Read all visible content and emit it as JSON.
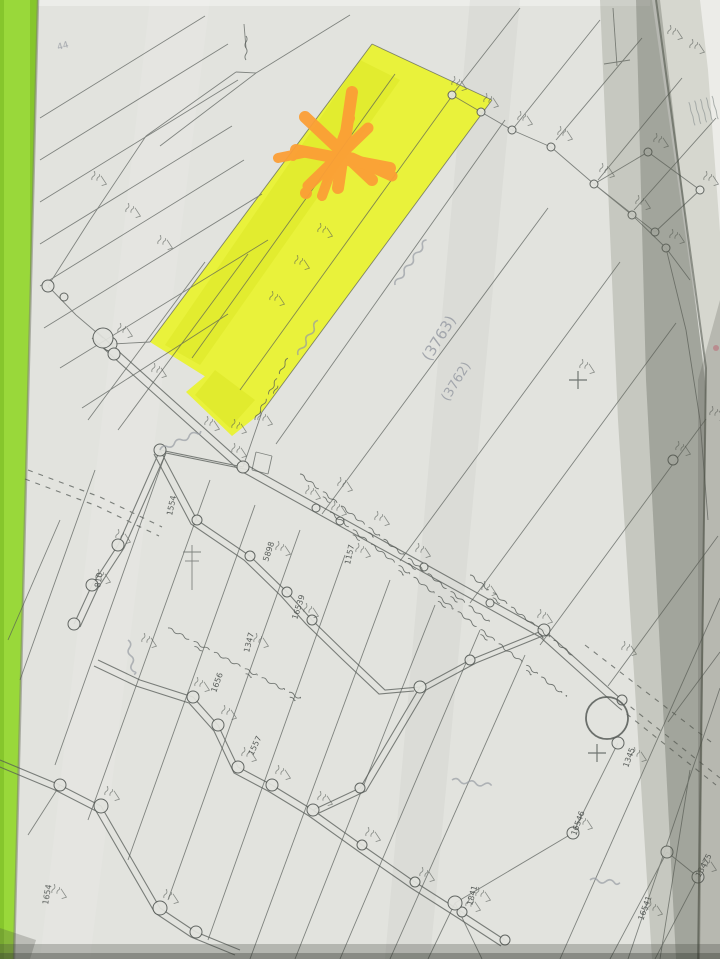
{
  "meta": {
    "description": "Photograph of a hand-drawn cadastral parcel survey map on grey paper lying on a green surface; one long parcel is highlighted in yellow with an orange marker asterisk; roads, survey-marker circles and handwritten parcel numbers cover the sheet"
  },
  "colors": {
    "green_bg": "#86c62c",
    "green_light": "#9bd93c",
    "paper": "#e2e3de",
    "under_sheet": "#d6d7cf",
    "white_corner": "#ecece8",
    "ink": "#565b57",
    "pencil": "#989ca4",
    "highlight": "#e9f23b",
    "highlight_dark": "#d9e422",
    "orange": "#fb9f36",
    "pink_dot": "#d98f98"
  },
  "canvas": {
    "width": 720,
    "height": 959
  },
  "sheets": {
    "under": [
      [
        640,
        0
      ],
      [
        720,
        0
      ],
      [
        720,
        959
      ],
      [
        660,
        959
      ]
    ],
    "white_corner": [
      [
        700,
        0
      ],
      [
        720,
        0
      ],
      [
        720,
        232
      ],
      [
        708,
        70
      ]
    ],
    "map": [
      [
        38,
        0
      ],
      [
        656,
        0
      ],
      [
        706,
        360
      ],
      [
        698,
        959
      ],
      [
        14,
        959
      ]
    ],
    "fineprint": {
      "x": 712,
      "y": 96,
      "rot": 75,
      "rows": 5,
      "len": 24,
      "gap": 6
    }
  },
  "highlight_parcel": {
    "main": [
      [
        372,
        44
      ],
      [
        492,
        100
      ],
      [
        262,
        412
      ],
      [
        150,
        342
      ]
    ],
    "tail": [
      [
        210,
        372
      ],
      [
        262,
        412
      ],
      [
        232,
        436
      ],
      [
        186,
        392
      ]
    ],
    "streaks": [
      {
        "pts": [
          [
            360,
            60
          ],
          [
            400,
            80
          ],
          [
            200,
            365
          ],
          [
            165,
            345
          ]
        ],
        "o": 0.45
      },
      {
        "pts": [
          [
            215,
            370
          ],
          [
            255,
            400
          ],
          [
            230,
            428
          ],
          [
            195,
            395
          ]
        ],
        "o": 0.5
      }
    ]
  },
  "lines": [
    [
      40,
      118,
      205,
      16
    ],
    [
      40,
      160,
      228,
      44
    ],
    [
      40,
      202,
      238,
      80
    ],
    [
      40,
      244,
      232,
      126
    ],
    [
      40,
      286,
      244,
      160
    ],
    [
      44,
      328,
      262,
      194
    ],
    [
      60,
      368,
      268,
      240
    ],
    [
      82,
      408,
      228,
      314
    ],
    [
      88,
      420,
      205,
      262
    ],
    [
      118,
      430,
      248,
      254
    ],
    [
      236,
      72,
      146,
      136
    ],
    [
      256,
      73,
      160,
      146
    ],
    [
      236,
      72,
      256,
      73
    ],
    [
      350,
      15,
      256,
      73
    ],
    [
      246,
      48,
      244,
      24
    ],
    [
      146,
      136,
      90,
      220
    ],
    [
      90,
      220,
      48,
      286
    ],
    [
      48,
      286,
      76,
      315
    ],
    [
      76,
      315,
      103,
      338
    ],
    [
      150,
      342,
      112,
      344
    ],
    [
      262,
      412,
      243,
      467
    ],
    [
      372,
      44,
      492,
      100
    ],
    [
      372,
      44,
      150,
      342
    ],
    [
      492,
      100,
      262,
      412
    ],
    [
      395,
      74,
      192,
      358
    ],
    [
      452,
      96,
      240,
      390
    ],
    [
      276,
      444,
      505,
      120
    ],
    [
      322,
      514,
      548,
      208
    ],
    [
      400,
      561,
      620,
      262
    ],
    [
      470,
      603,
      676,
      323
    ],
    [
      540,
      645,
      706,
      419
    ],
    [
      608,
      686,
      718,
      536
    ],
    [
      668,
      722,
      720,
      652
    ],
    [
      452,
      95,
      520,
      8
    ],
    [
      512,
      130,
      600,
      20
    ],
    [
      556,
      140,
      642,
      38
    ],
    [
      598,
      180,
      682,
      78
    ],
    [
      634,
      210,
      716,
      118
    ],
    [
      452,
      95,
      481,
      112
    ],
    [
      481,
      112,
      512,
      130
    ],
    [
      512,
      130,
      551,
      147
    ],
    [
      551,
      147,
      594,
      184
    ],
    [
      594,
      184,
      632,
      215
    ],
    [
      632,
      215,
      666,
      248
    ],
    [
      666,
      248,
      690,
      280
    ],
    [
      594,
      184,
      648,
      152
    ],
    [
      648,
      152,
      700,
      190
    ],
    [
      700,
      190,
      655,
      232
    ],
    [
      655,
      232,
      594,
      184
    ],
    [
      613,
      8,
      617,
      66
    ],
    [
      604,
      64,
      630,
      60
    ],
    [
      666,
      248,
      686,
      330
    ],
    [
      686,
      330,
      700,
      420
    ],
    [
      700,
      420,
      708,
      520
    ],
    [
      165,
      455,
      55,
      765
    ],
    [
      210,
      480,
      88,
      820
    ],
    [
      255,
      505,
      128,
      860
    ],
    [
      300,
      530,
      168,
      900
    ],
    [
      345,
      555,
      208,
      940
    ],
    [
      390,
      580,
      250,
      959
    ],
    [
      435,
      605,
      295,
      959
    ],
    [
      480,
      630,
      340,
      959
    ],
    [
      525,
      655,
      390,
      959
    ],
    [
      95,
      470,
      20,
      680
    ],
    [
      60,
      520,
      8,
      640
    ],
    [
      720,
      598,
      560,
      959
    ],
    [
      720,
      688,
      628,
      959
    ],
    [
      690,
      770,
      660,
      959
    ],
    [
      667,
      852,
      610,
      959
    ],
    [
      698,
      877,
      655,
      959
    ],
    [
      618,
      743,
      573,
      833
    ],
    [
      573,
      833,
      455,
      903
    ],
    [
      455,
      903,
      428,
      959
    ],
    [
      455,
      903,
      482,
      959
    ],
    [
      667,
      852,
      698,
      877
    ],
    [
      60,
      785,
      28,
      835
    ],
    [
      192,
      545,
      192,
      590
    ],
    [
      183,
      552,
      201,
      552
    ],
    [
      185,
      561,
      199,
      561
    ],
    [
      256,
      452,
      272,
      456
    ],
    [
      272,
      456,
      268,
      474
    ],
    [
      268,
      474,
      252,
      470
    ],
    [
      252,
      470,
      256,
      452
    ]
  ],
  "roads": [
    {
      "pts": [
        [
          96,
          331
        ],
        [
          243,
          463
        ],
        [
          544,
          630
        ],
        [
          622,
          700
        ]
      ],
      "off": [
        -4,
        7
      ],
      "dash": false
    },
    {
      "pts": [
        [
          622,
          700
        ],
        [
          720,
          778
        ]
      ],
      "off": [
        -4,
        7
      ],
      "dash": true
    },
    {
      "pts": [
        [
          243,
          467
        ],
        [
          160,
          450
        ],
        [
          118,
          545
        ],
        [
          92,
          585
        ],
        [
          74,
          624
        ]
      ],
      "off": [
        6,
        3
      ],
      "dash": false
    },
    {
      "pts": [
        [
          98,
          660
        ],
        [
          140,
          680
        ],
        [
          193,
          697
        ],
        [
          218,
          725
        ],
        [
          238,
          767
        ],
        [
          272,
          785
        ],
        [
          313,
          810
        ],
        [
          362,
          845
        ],
        [
          415,
          882
        ],
        [
          462,
          912
        ],
        [
          505,
          940
        ]
      ],
      "off": [
        -4,
        6
      ],
      "dash": false
    },
    {
      "pts": [
        [
          313,
          810
        ],
        [
          360,
          788
        ],
        [
          420,
          687
        ],
        [
          470,
          660
        ],
        [
          544,
          630
        ]
      ],
      "off": [
        6,
        3
      ],
      "dash": false
    },
    {
      "pts": [
        [
          0,
          760
        ],
        [
          60,
          785
        ],
        [
          101,
          806
        ],
        [
          160,
          908
        ],
        [
          196,
          932
        ],
        [
          240,
          950
        ]
      ],
      "off": [
        -5,
        5
      ],
      "dash": false
    },
    {
      "pts": [
        [
          160,
          450
        ],
        [
          197,
          520
        ],
        [
          250,
          556
        ],
        [
          287,
          592
        ],
        [
          312,
          620
        ],
        [
          348,
          655
        ],
        [
          385,
          690
        ],
        [
          420,
          687
        ]
      ],
      "off": [
        -6,
        4
      ],
      "dash": false
    },
    {
      "pts": [
        [
          28,
          470
        ],
        [
          100,
          497
        ],
        [
          162,
          527
        ]
      ],
      "off": [
        -3,
        9
      ],
      "dash": true
    },
    {
      "pts": [
        [
          585,
          645
        ],
        [
          715,
          745
        ]
      ],
      "off": null,
      "dash": true
    }
  ],
  "circles": [
    [
      110,
      344,
      7
    ],
    [
      243,
      467,
      6
    ],
    [
      316,
      508,
      4
    ],
    [
      340,
      521,
      4
    ],
    [
      424,
      567,
      4
    ],
    [
      490,
      603,
      4
    ],
    [
      544,
      630,
      6
    ],
    [
      622,
      700,
      5
    ],
    [
      452,
      95,
      4
    ],
    [
      481,
      112,
      4
    ],
    [
      512,
      130,
      4
    ],
    [
      551,
      147,
      4
    ],
    [
      594,
      184,
      4
    ],
    [
      632,
      215,
      4
    ],
    [
      666,
      248,
      4
    ],
    [
      648,
      152,
      4
    ],
    [
      700,
      190,
      4
    ],
    [
      655,
      232,
      4
    ],
    [
      48,
      286,
      6
    ],
    [
      64,
      297,
      4
    ],
    [
      103,
      338,
      10
    ],
    [
      114,
      354,
      6
    ],
    [
      160,
      450,
      6
    ],
    [
      118,
      545,
      6
    ],
    [
      92,
      585,
      6
    ],
    [
      74,
      624,
      6
    ],
    [
      193,
      697,
      6
    ],
    [
      218,
      725,
      6
    ],
    [
      238,
      767,
      6
    ],
    [
      272,
      785,
      6
    ],
    [
      313,
      810,
      6
    ],
    [
      362,
      845,
      5
    ],
    [
      415,
      882,
      5
    ],
    [
      462,
      912,
      5
    ],
    [
      505,
      940,
      5
    ],
    [
      360,
      788,
      5
    ],
    [
      420,
      687,
      6
    ],
    [
      470,
      660,
      5
    ],
    [
      60,
      785,
      6
    ],
    [
      101,
      806,
      7
    ],
    [
      160,
      908,
      7
    ],
    [
      196,
      932,
      6
    ],
    [
      197,
      520,
      5
    ],
    [
      250,
      556,
      5
    ],
    [
      287,
      592,
      5
    ],
    [
      312,
      620,
      5
    ],
    [
      618,
      743,
      6
    ],
    [
      573,
      833,
      6
    ],
    [
      455,
      903,
      7
    ],
    [
      667,
      852,
      6
    ],
    [
      698,
      877,
      6
    ],
    [
      673,
      460,
      5
    ]
  ],
  "big_circle": [
    607,
    718,
    21
  ],
  "crosses": [
    [
      578,
      380
    ],
    [
      597,
      753
    ]
  ],
  "pink_dot": [
    716,
    348,
    3
  ],
  "marker_scribble": {
    "strokes": [
      [
        352,
        92,
        338,
        188,
        12
      ],
      [
        305,
        117,
        372,
        180,
        12
      ],
      [
        296,
        150,
        390,
        168,
        12
      ],
      [
        308,
        186,
        368,
        128,
        11
      ],
      [
        322,
        196,
        350,
        118,
        10
      ],
      [
        278,
        158,
        308,
        152,
        10
      ],
      [
        352,
        158,
        392,
        176,
        11
      ]
    ],
    "dots": [
      [
        306,
        193,
        6
      ],
      [
        293,
        157,
        4
      ]
    ],
    "ring": [
      339,
      182,
      4.5
    ]
  },
  "handwriting_bands": [
    [
      300,
      474,
      38,
      240
    ],
    [
      330,
      512,
      38,
      300
    ],
    [
      470,
      575,
      38,
      130
    ],
    [
      168,
      628,
      28,
      150
    ],
    [
      255,
      420,
      -62,
      70
    ],
    [
      246,
      36,
      90,
      26
    ]
  ],
  "pencil_scribbles": [
    [
      395,
      285,
      -55,
      55
    ],
    [
      160,
      450,
      -25,
      45
    ],
    [
      128,
      640,
      80,
      35
    ],
    [
      452,
      780,
      8,
      40
    ],
    [
      590,
      880,
      5,
      30
    ],
    [
      298,
      355,
      -60,
      40
    ]
  ],
  "micro_marks": [
    [
      118,
      332
    ],
    [
      152,
      372
    ],
    [
      232,
      452
    ],
    [
      306,
      494
    ],
    [
      332,
      510
    ],
    [
      416,
      552
    ],
    [
      482,
      590
    ],
    [
      538,
      618
    ],
    [
      205,
      425
    ],
    [
      232,
      428
    ],
    [
      258,
      420
    ],
    [
      270,
      300
    ],
    [
      295,
      264
    ],
    [
      318,
      232
    ],
    [
      452,
      85
    ],
    [
      484,
      102
    ],
    [
      518,
      120
    ],
    [
      558,
      135
    ],
    [
      600,
      172
    ],
    [
      636,
      204
    ],
    [
      670,
      238
    ],
    [
      654,
      142
    ],
    [
      704,
      180
    ],
    [
      580,
      368
    ],
    [
      676,
      450
    ],
    [
      195,
      686
    ],
    [
      222,
      714
    ],
    [
      242,
      756
    ],
    [
      276,
      774
    ],
    [
      318,
      800
    ],
    [
      366,
      836
    ],
    [
      420,
      876
    ],
    [
      466,
      906
    ],
    [
      105,
      795
    ],
    [
      164,
      898
    ],
    [
      578,
      824
    ],
    [
      476,
      896
    ],
    [
      702,
      866
    ],
    [
      648,
      910
    ],
    [
      52,
      893
    ],
    [
      632,
      756
    ],
    [
      116,
      538
    ],
    [
      96,
      578
    ],
    [
      142,
      642
    ],
    [
      254,
      642
    ],
    [
      276,
      550
    ],
    [
      304,
      612
    ],
    [
      356,
      552
    ],
    [
      92,
      180
    ],
    [
      126,
      212
    ],
    [
      158,
      244
    ],
    [
      690,
      48
    ],
    [
      668,
      34
    ],
    [
      710,
      415
    ],
    [
      622,
      650
    ],
    [
      338,
      486
    ],
    [
      375,
      520
    ]
  ],
  "labels": [
    {
      "t": "1157",
      "x": 350,
      "y": 565,
      "r": -78,
      "s": 8
    },
    {
      "t": "1554",
      "x": 172,
      "y": 516,
      "r": -78,
      "s": 8
    },
    {
      "t": "810",
      "x": 100,
      "y": 588,
      "r": -80,
      "s": 8
    },
    {
      "t": "5898",
      "x": 268,
      "y": 562,
      "r": -72,
      "s": 8
    },
    {
      "t": "16539",
      "x": 297,
      "y": 620,
      "r": -72,
      "s": 8
    },
    {
      "t": "1347",
      "x": 249,
      "y": 653,
      "r": -76,
      "s": 8
    },
    {
      "t": "1557",
      "x": 253,
      "y": 756,
      "r": -65,
      "s": 8
    },
    {
      "t": "16546",
      "x": 576,
      "y": 836,
      "r": -70,
      "s": 8
    },
    {
      "t": "1841",
      "x": 472,
      "y": 906,
      "r": -75,
      "s": 8
    },
    {
      "t": "13475",
      "x": 700,
      "y": 878,
      "r": -62,
      "s": 8
    },
    {
      "t": "16541",
      "x": 643,
      "y": 921,
      "r": -70,
      "s": 8
    },
    {
      "t": "1654",
      "x": 48,
      "y": 905,
      "r": -80,
      "s": 8
    },
    {
      "t": "1345",
      "x": 628,
      "y": 768,
      "r": -70,
      "s": 8
    },
    {
      "t": "1656",
      "x": 216,
      "y": 693,
      "r": -70,
      "s": 8
    }
  ],
  "pencil_labels": [
    {
      "t": "(3763)",
      "x": 430,
      "y": 362,
      "r": -58,
      "s": 15
    },
    {
      "t": "(3762)",
      "x": 448,
      "y": 402,
      "r": -58,
      "s": 13
    },
    {
      "t": "44",
      "x": 58,
      "y": 50,
      "r": -15,
      "s": 9
    }
  ],
  "shadows": {
    "band1": [
      [
        600,
        0
      ],
      [
        652,
        0
      ],
      [
        706,
        380
      ],
      [
        700,
        959
      ],
      [
        652,
        959
      ],
      [
        618,
        420
      ]
    ],
    "band2": [
      [
        636,
        0
      ],
      [
        660,
        0
      ],
      [
        706,
        390
      ],
      [
        700,
        959
      ],
      [
        676,
        959
      ],
      [
        646,
        380
      ]
    ],
    "edge": [
      [
        656,
        0
      ],
      [
        706,
        368
      ],
      [
        698,
        959
      ]
    ],
    "right_low": [
      [
        698,
        380
      ],
      [
        720,
        300
      ],
      [
        720,
        959
      ],
      [
        698,
        959
      ]
    ],
    "corner_blob": [
      [
        0,
        928
      ],
      [
        36,
        940
      ],
      [
        30,
        959
      ],
      [
        0,
        959
      ]
    ],
    "streak_light": [
      [
        150,
        0
      ],
      [
        210,
        0
      ],
      [
        90,
        959
      ],
      [
        40,
        959
      ]
    ],
    "streak_dark": [
      [
        470,
        0
      ],
      [
        520,
        0
      ],
      [
        430,
        959
      ],
      [
        385,
        959
      ]
    ]
  }
}
